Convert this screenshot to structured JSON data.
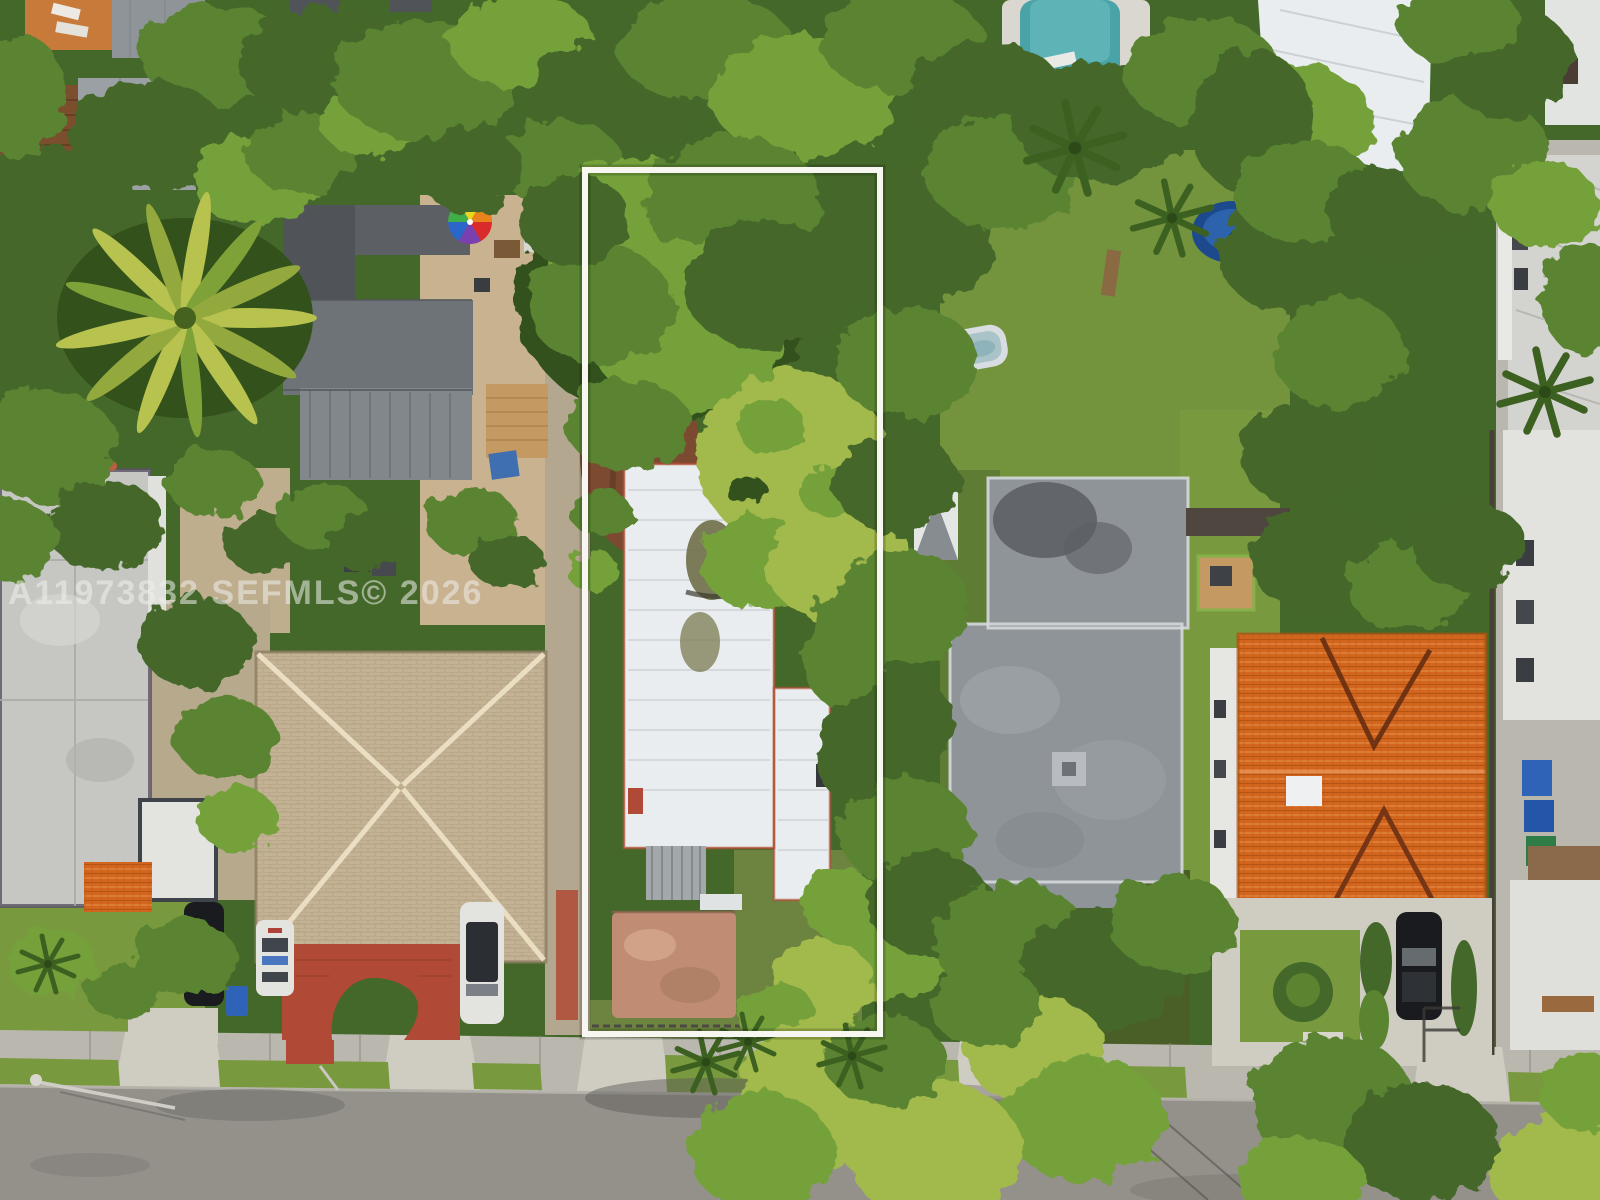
{
  "image": {
    "type": "aerial-drone-photograph",
    "subject": "Top-down real-estate aerial photo of a residential block; a narrow vacant-style lot with a white flat-roof house is outlined by a white rectangle annotation",
    "orientation": "top-down"
  },
  "watermark": {
    "text": "A11973832 SEFMLS© 2026",
    "mls_number": "A11973832",
    "source": "SEFMLS",
    "year": "2026"
  },
  "annotations": {
    "property_outline": {
      "shape": "rectangle",
      "color": "#f7f6f0",
      "x": 585,
      "y": 170,
      "width": 295,
      "height": 864
    }
  },
  "scene": {
    "landmarks": [
      "outlined lot with white flat-roof house, dirt patch, pink concrete patio and lawn",
      "dense green tree canopy across the block",
      "large palm tree over left yard",
      "rainbow patio umbrella beside dark flat-roof building",
      "diamond-pattern tan shingle hip roof house",
      "red brick horseshoe driveway with grass inset",
      "parked cars: black SUV, white police car, white SUV, black sedan",
      "gray flat-roof house with rear wood deck",
      "backyard kiddie pool and blue trampoline",
      "swimming pool with white deck at top",
      "orange barrel-tile roof house with front gable",
      "blue and green trash bins along right alley",
      "street with sidewalk, grass parkway and small palms",
      "white multifamily building at right edge"
    ]
  },
  "palette": {
    "canopy-deep": "#33511b",
    "canopy-dark": "#44682a",
    "canopy-mid": "#5a8430",
    "canopy-bright": "#74a13a",
    "canopy-yellow": "#a2b94c",
    "lawn": "#79993f",
    "lawn-olive": "#6d8440",
    "sand": "#c9b28f",
    "dirt": "#7b4a31",
    "asphalt": "#94918b",
    "sidewalk": "#bab7ae",
    "concrete-light": "#cfccc2",
    "outline": "#f7f6f0",
    "roof-white": "#e9edef",
    "roof-gray": "#8f9499",
    "roof-dark": "#505459",
    "roof-tan": "#c4b295",
    "roof-brown": "#7b4e2d",
    "roof-orange": "#d2661e",
    "tile-red": "#b04a36",
    "patio-pink": "#c08d74",
    "pool-teal": "#4aa3a7",
    "pool-deck": "#d9d7cf",
    "bin-blue": "#2f63b8",
    "bin-teal": "#2e8f86",
    "bin-green": "#2e7d46",
    "car-black": "#191b1f",
    "car-white": "#e3e4e0",
    "wood": "#c49a62",
    "watermark": "#f0efec"
  }
}
